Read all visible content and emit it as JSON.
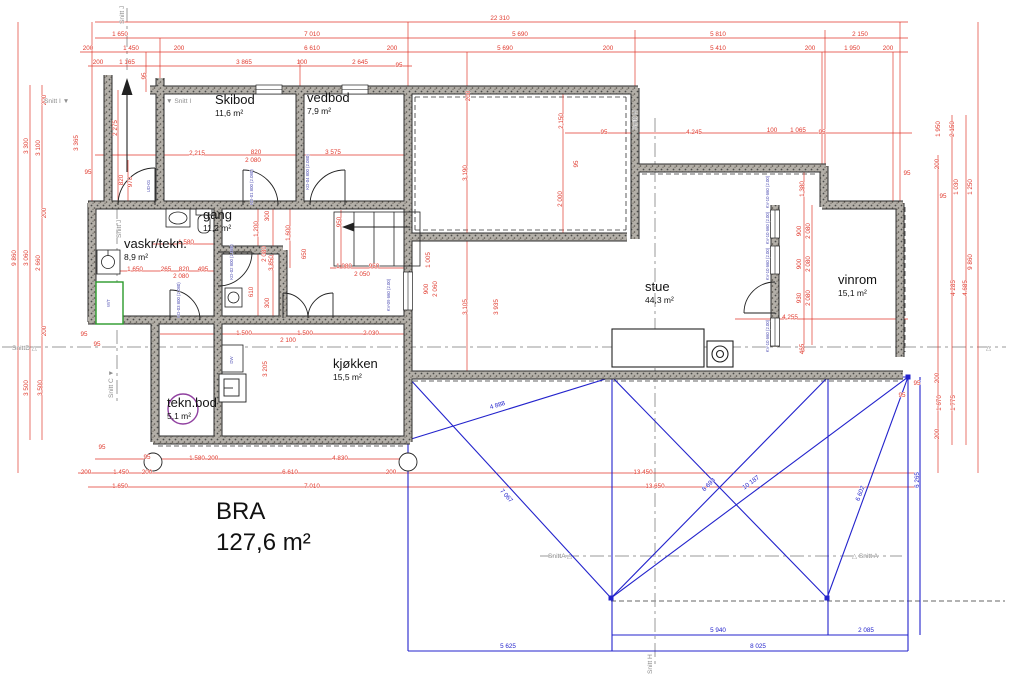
{
  "drawing": {
    "bra_label": "BRA",
    "bra_value": "127,6 m²"
  },
  "rooms": [
    {
      "name": "Skibod",
      "area": "11,6 m²",
      "x": 215,
      "y": 104
    },
    {
      "name": "vedbod",
      "area": "7,9 m²",
      "x": 307,
      "y": 102
    },
    {
      "name": "gang",
      "area": "11,2 m²",
      "x": 203,
      "y": 219
    },
    {
      "name": "vaskr/tekn.",
      "area": "8,9 m²",
      "x": 124,
      "y": 248
    },
    {
      "name": "tekn.bod",
      "area": "5,1 m²",
      "x": 167,
      "y": 407
    },
    {
      "name": "kjøkken",
      "area": "15,5 m²",
      "x": 333,
      "y": 368
    },
    {
      "name": "stue",
      "area": "44,3 m²",
      "x": 645,
      "y": 291
    },
    {
      "name": "vinrom",
      "area": "15,1 m²",
      "x": 838,
      "y": 284
    }
  ],
  "sections": [
    {
      "t": "Snitt J",
      "x": 124,
      "y": 24,
      "v": 1
    },
    {
      "t": "Snitt I ▼",
      "x": 44,
      "y": 103
    },
    {
      "t": "▼ Snitt I",
      "x": 166,
      "y": 103
    },
    {
      "t": "Snitt H",
      "x": 637,
      "y": 130,
      "v": 1
    },
    {
      "t": "Snitt J",
      "x": 121,
      "y": 238,
      "v": 1
    },
    {
      "t": "Snitt C ▼",
      "x": 113,
      "y": 398,
      "v": 1
    },
    {
      "t": "SnittD △",
      "x": 12,
      "y": 350
    },
    {
      "t": "△",
      "x": 986,
      "y": 350
    },
    {
      "t": "SnittA △",
      "x": 548,
      "y": 558
    },
    {
      "t": "△ Snitt A",
      "x": 852,
      "y": 558
    },
    {
      "t": "Snitt H",
      "x": 652,
      "y": 674,
      "v": 1
    }
  ],
  "dims_red": [
    {
      "t": "22 310",
      "x": 500,
      "y": 20
    },
    {
      "t": "1 650",
      "x": 120,
      "y": 36
    },
    {
      "t": "7 010",
      "x": 312,
      "y": 36
    },
    {
      "t": "5 690",
      "x": 520,
      "y": 36
    },
    {
      "t": "5 810",
      "x": 718,
      "y": 36
    },
    {
      "t": "2 150",
      "x": 860,
      "y": 36
    },
    {
      "t": "200",
      "x": 88,
      "y": 50
    },
    {
      "t": "1 450",
      "x": 131,
      "y": 50
    },
    {
      "t": "200",
      "x": 179,
      "y": 50
    },
    {
      "t": "6 610",
      "x": 312,
      "y": 50
    },
    {
      "t": "200",
      "x": 392,
      "y": 50
    },
    {
      "t": "5 690",
      "x": 505,
      "y": 50
    },
    {
      "t": "200",
      "x": 608,
      "y": 50
    },
    {
      "t": "5 410",
      "x": 718,
      "y": 50
    },
    {
      "t": "200",
      "x": 810,
      "y": 50
    },
    {
      "t": "1 950",
      "x": 852,
      "y": 50
    },
    {
      "t": "200",
      "x": 888,
      "y": 50
    },
    {
      "t": "200",
      "x": 98,
      "y": 64
    },
    {
      "t": "1 165",
      "x": 127,
      "y": 64
    },
    {
      "t": "3 865",
      "x": 244,
      "y": 64
    },
    {
      "t": "100",
      "x": 302,
      "y": 64
    },
    {
      "t": "2 645",
      "x": 360,
      "y": 64
    },
    {
      "t": "95",
      "x": 399,
      "y": 67
    },
    {
      "t": "200",
      "x": 46,
      "y": 100,
      "v": 1
    },
    {
      "t": "3 300",
      "x": 28,
      "y": 146,
      "v": 1
    },
    {
      "t": "3 100",
      "x": 40,
      "y": 148,
      "v": 1
    },
    {
      "t": "3 365",
      "x": 78,
      "y": 143,
      "v": 1
    },
    {
      "t": "2 275",
      "x": 117,
      "y": 128,
      "v": 1
    },
    {
      "t": "95",
      "x": 146,
      "y": 76,
      "v": 1
    },
    {
      "t": "9 860",
      "x": 16,
      "y": 258,
      "v": 1
    },
    {
      "t": "200",
      "x": 46,
      "y": 213,
      "v": 1
    },
    {
      "t": "3 060",
      "x": 28,
      "y": 258,
      "v": 1
    },
    {
      "t": "2 660",
      "x": 40,
      "y": 263,
      "v": 1
    },
    {
      "t": "95",
      "x": 88,
      "y": 174
    },
    {
      "t": "200",
      "x": 46,
      "y": 331,
      "v": 1
    },
    {
      "t": "3 500",
      "x": 28,
      "y": 388,
      "v": 1
    },
    {
      "t": "3 500",
      "x": 42,
      "y": 388,
      "v": 1
    },
    {
      "t": "95",
      "x": 84,
      "y": 336
    },
    {
      "t": "95",
      "x": 97,
      "y": 346
    },
    {
      "t": "820",
      "x": 123,
      "y": 180,
      "v": 1
    },
    {
      "t": "970",
      "x": 132,
      "y": 182,
      "v": 1
    },
    {
      "t": "2 215",
      "x": 197,
      "y": 155
    },
    {
      "t": "820",
      "x": 256,
      "y": 154
    },
    {
      "t": "2 080",
      "x": 253,
      "y": 162
    },
    {
      "t": "3 575",
      "x": 333,
      "y": 154
    },
    {
      "t": "1 580",
      "x": 186,
      "y": 244
    },
    {
      "t": "1 650",
      "x": 135,
      "y": 271
    },
    {
      "t": "265",
      "x": 166,
      "y": 271
    },
    {
      "t": "820",
      "x": 184,
      "y": 271
    },
    {
      "t": "495",
      "x": 203,
      "y": 271
    },
    {
      "t": "2 080",
      "x": 181,
      "y": 278
    },
    {
      "t": "1 200",
      "x": 258,
      "y": 229,
      "v": 1
    },
    {
      "t": "2 080",
      "x": 266,
      "y": 254,
      "v": 1
    },
    {
      "t": "610",
      "x": 253,
      "y": 292,
      "v": 1
    },
    {
      "t": "3 850",
      "x": 273,
      "y": 263,
      "v": 1
    },
    {
      "t": "300",
      "x": 269,
      "y": 216,
      "v": 1
    },
    {
      "t": "300",
      "x": 269,
      "y": 303,
      "v": 1
    },
    {
      "t": "1 600",
      "x": 290,
      "y": 233,
      "v": 1
    },
    {
      "t": "950",
      "x": 341,
      "y": 222,
      "v": 1
    },
    {
      "t": "650",
      "x": 306,
      "y": 254,
      "v": 1
    },
    {
      "t": "1 080",
      "x": 344,
      "y": 268
    },
    {
      "t": "950",
      "x": 374,
      "y": 268
    },
    {
      "t": "2 050",
      "x": 362,
      "y": 276
    },
    {
      "t": "1 500",
      "x": 244,
      "y": 335
    },
    {
      "t": "1 500",
      "x": 305,
      "y": 335
    },
    {
      "t": "2 030",
      "x": 371,
      "y": 335
    },
    {
      "t": "2 100",
      "x": 288,
      "y": 342
    },
    {
      "t": "3 205",
      "x": 267,
      "y": 369,
      "v": 1
    },
    {
      "t": "200",
      "x": 470,
      "y": 96,
      "v": 1
    },
    {
      "t": "3 190",
      "x": 467,
      "y": 173,
      "v": 1
    },
    {
      "t": "2 150",
      "x": 563,
      "y": 121,
      "v": 1
    },
    {
      "t": "2 000",
      "x": 562,
      "y": 199,
      "v": 1
    },
    {
      "t": "95",
      "x": 578,
      "y": 164,
      "v": 1
    },
    {
      "t": "95",
      "x": 604,
      "y": 134
    },
    {
      "t": "4 245",
      "x": 694,
      "y": 134
    },
    {
      "t": "100",
      "x": 772,
      "y": 132
    },
    {
      "t": "1 065",
      "x": 798,
      "y": 132
    },
    {
      "t": "95",
      "x": 822,
      "y": 134
    },
    {
      "t": "1 005",
      "x": 430,
      "y": 260,
      "v": 1
    },
    {
      "t": "900",
      "x": 428,
      "y": 289,
      "v": 1
    },
    {
      "t": "2 060",
      "x": 437,
      "y": 289,
      "v": 1
    },
    {
      "t": "3 105",
      "x": 467,
      "y": 307,
      "v": 1
    },
    {
      "t": "3 935",
      "x": 498,
      "y": 307,
      "v": 1
    },
    {
      "t": "13 450",
      "x": 643,
      "y": 474
    },
    {
      "t": "13 650",
      "x": 655,
      "y": 488
    },
    {
      "t": "1 380",
      "x": 804,
      "y": 189,
      "v": 1
    },
    {
      "t": "900",
      "x": 801,
      "y": 231,
      "v": 1
    },
    {
      "t": "2 080",
      "x": 810,
      "y": 231,
      "v": 1
    },
    {
      "t": "900",
      "x": 801,
      "y": 264,
      "v": 1
    },
    {
      "t": "2 080",
      "x": 810,
      "y": 264,
      "v": 1
    },
    {
      "t": "930",
      "x": 801,
      "y": 298,
      "v": 1
    },
    {
      "t": "2 080",
      "x": 810,
      "y": 298,
      "v": 1
    },
    {
      "t": "4 255",
      "x": 790,
      "y": 319
    },
    {
      "t": "465",
      "x": 804,
      "y": 349,
      "v": 1
    },
    {
      "t": "95",
      "x": 907,
      "y": 175
    },
    {
      "t": "200",
      "x": 939,
      "y": 164,
      "v": 1
    },
    {
      "t": "1 950",
      "x": 940,
      "y": 129,
      "v": 1
    },
    {
      "t": "2 150",
      "x": 954,
      "y": 129,
      "v": 1
    },
    {
      "t": "95",
      "x": 943,
      "y": 198
    },
    {
      "t": "1 030",
      "x": 958,
      "y": 187,
      "v": 1
    },
    {
      "t": "1 250",
      "x": 972,
      "y": 187,
      "v": 1
    },
    {
      "t": "9 860",
      "x": 972,
      "y": 262,
      "v": 1
    },
    {
      "t": "4 285",
      "x": 955,
      "y": 288,
      "v": 1
    },
    {
      "t": "4 685",
      "x": 967,
      "y": 288,
      "v": 1
    },
    {
      "t": "200",
      "x": 939,
      "y": 378,
      "v": 1
    },
    {
      "t": "95",
      "x": 917,
      "y": 385
    },
    {
      "t": "95",
      "x": 902,
      "y": 397
    },
    {
      "t": "1 670",
      "x": 941,
      "y": 403,
      "v": 1
    },
    {
      "t": "1 775",
      "x": 955,
      "y": 403,
      "v": 1
    },
    {
      "t": "200",
      "x": 939,
      "y": 434,
      "v": 1
    },
    {
      "t": "95",
      "x": 102,
      "y": 449
    },
    {
      "t": "95",
      "x": 147,
      "y": 459
    },
    {
      "t": "1 580",
      "x": 197,
      "y": 460
    },
    {
      "t": "200",
      "x": 213,
      "y": 460
    },
    {
      "t": "4 830",
      "x": 340,
      "y": 460
    },
    {
      "t": "200",
      "x": 86,
      "y": 474
    },
    {
      "t": "1 450",
      "x": 121,
      "y": 474
    },
    {
      "t": "200",
      "x": 147,
      "y": 474
    },
    {
      "t": "6 610",
      "x": 290,
      "y": 474
    },
    {
      "t": "200",
      "x": 391,
      "y": 474
    },
    {
      "t": "1 650",
      "x": 120,
      "y": 488
    },
    {
      "t": "7 010",
      "x": 312,
      "y": 488
    }
  ],
  "dims_blue": [
    {
      "t": "5 940",
      "x": 718,
      "y": 632
    },
    {
      "t": "2 085",
      "x": 866,
      "y": 632
    },
    {
      "t": "5 625",
      "x": 508,
      "y": 648
    },
    {
      "t": "8 025",
      "x": 758,
      "y": 648
    },
    {
      "t": "6 265",
      "x": 919,
      "y": 480,
      "v": 1
    },
    {
      "t": "4 888",
      "x": 498,
      "y": 407,
      "r": -17
    },
    {
      "t": "7 067",
      "x": 505,
      "y": 497,
      "r": 48
    },
    {
      "t": "8 693",
      "x": 710,
      "y": 486,
      "r": -45
    },
    {
      "t": "10 187",
      "x": 752,
      "y": 484,
      "r": -37
    },
    {
      "t": "6 602",
      "x": 862,
      "y": 494,
      "r": -70
    }
  ],
  "fixture_labels": [
    {
      "t": "W/T",
      "x": 110,
      "y": 303,
      "v": 1
    },
    {
      "t": "DW",
      "x": 233,
      "y": 360,
      "v": 1
    },
    {
      "t": "KV-10 660 (2.00)",
      "x": 769,
      "y": 192,
      "v": 1
    },
    {
      "t": "KV-10 660 (2.00)",
      "x": 769,
      "y": 228,
      "v": 1
    },
    {
      "t": "KV-10 660 (2.00)",
      "x": 769,
      "y": 264,
      "v": 1
    },
    {
      "t": "KV-10 660 (2.00)",
      "x": 769,
      "y": 336,
      "v": 1
    },
    {
      "t": "KV-09 660 (2.00)",
      "x": 390,
      "y": 295,
      "v": 1
    },
    {
      "t": "UD-01",
      "x": 150,
      "y": 186,
      "v": 1
    },
    {
      "t": "KD-01 800 (2.080)",
      "x": 253,
      "y": 187,
      "v": 1
    },
    {
      "t": "KD-04 800 (2.080)",
      "x": 309,
      "y": 172,
      "v": 1
    },
    {
      "t": "KD-02 800 (2.080)",
      "x": 233,
      "y": 262,
      "v": 1
    },
    {
      "t": "KD-03 800 (2.080)",
      "x": 180,
      "y": 300,
      "v": 1
    }
  ],
  "colors": {
    "dimension_red": "#e0392d",
    "roof_blue": "#2323cc",
    "wall_gray": "#4a4a4a",
    "section_gray": "#8e8e8e",
    "appliance_green": "#2a9a2a",
    "chimney_purple": "#9040a0"
  }
}
